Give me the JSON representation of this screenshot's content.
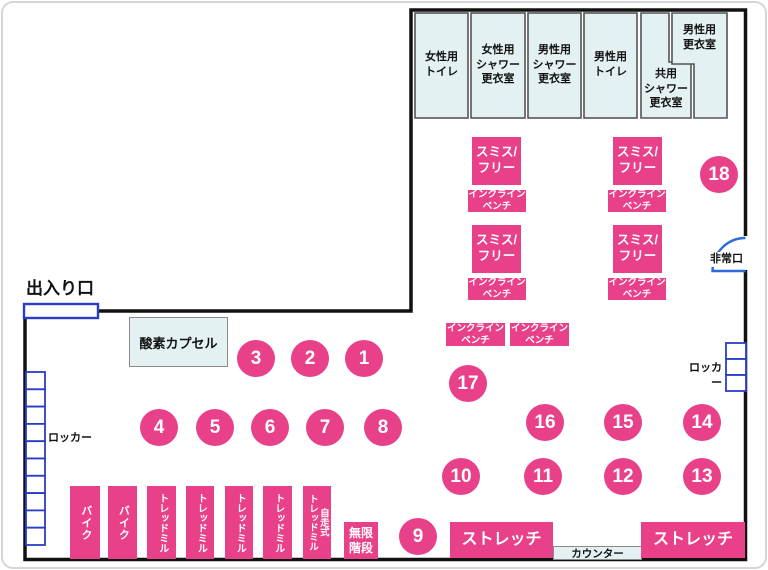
{
  "map": {
    "entrance_label": "出入り口",
    "emergency_exit_label": "非常口",
    "oxygen_capsule_label": "酸素カプセル",
    "locker_label_left": "ロッカー",
    "locker_label_right": "ロッカー",
    "counter_label": "カウンター"
  },
  "rooms": [
    {
      "id": "womens-toilet",
      "label": "女性用\nトイレ"
    },
    {
      "id": "womens-shower-locker",
      "label": "女性用\nシャワー\n更衣室"
    },
    {
      "id": "mens-shower-locker",
      "label": "男性用\nシャワー\n更衣室"
    },
    {
      "id": "mens-toilet",
      "label": "男性用\nトイレ"
    },
    {
      "id": "shared-shower-locker",
      "label": "共用\nシャワー\n更衣室"
    },
    {
      "id": "mens-locker-room",
      "label": "男性用\n更衣室"
    }
  ],
  "equipment": {
    "smith_free_label": "スミス/\nフリー",
    "incline_bench_label": "インクライン\nベンチ",
    "bike_label": "バイク",
    "treadmill_label": "トレッドミル",
    "self_treadmill_label": "自走式\nトレッドミル",
    "stairs_label": "無限\n階段",
    "stretch_label": "ストレッチ"
  },
  "stations": [
    "1",
    "2",
    "3",
    "4",
    "5",
    "6",
    "7",
    "8",
    "9",
    "10",
    "11",
    "12",
    "13",
    "14",
    "15",
    "16",
    "17",
    "18"
  ],
  "colors": {
    "pink": "#e8418a",
    "room_fill": "#e3f1f3",
    "locker_blue": "#2b3cc9",
    "door_blue": "#2e6ad9",
    "wall": "#111111"
  }
}
